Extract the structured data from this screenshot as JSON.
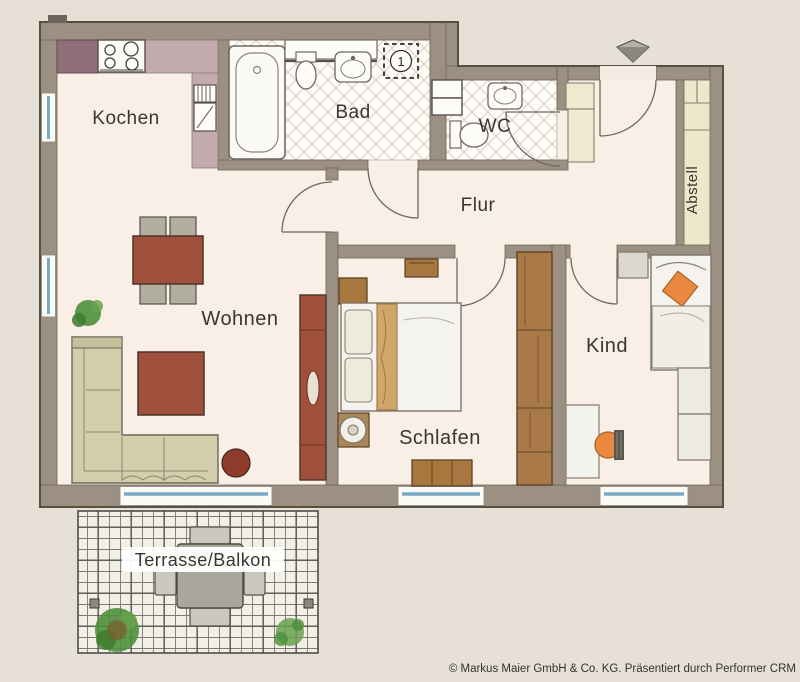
{
  "plan": {
    "rooms": {
      "kochen": {
        "label": "Kochen"
      },
      "bad": {
        "label": "Bad"
      },
      "wc": {
        "label": "WC"
      },
      "flur": {
        "label": "Flur"
      },
      "abstell": {
        "label": "Abstell"
      },
      "wohnen": {
        "label": "Wohnen"
      },
      "schlafen": {
        "label": "Schlafen"
      },
      "kind": {
        "label": "Kind"
      },
      "terrasse": {
        "label": "Terrasse/Balkon"
      }
    },
    "markers": {
      "entrance_number": "1"
    },
    "colors": {
      "background": "#e7e0d7",
      "wall": "#9c9083",
      "floor": "#f9efe7",
      "tile": "#fdfcf8",
      "abstell_floor": "#ede7cb",
      "window_glass": "#7aa9c4",
      "furniture_red": "#a0513d",
      "furniture_brown": "#a8763f",
      "accent_orange": "#e8893f",
      "sofa": "#d5cead",
      "plant_green": "#4e8f3c"
    }
  },
  "footer": {
    "copyright": "© Markus Maier GmbH & Co. KG. Präsentiert durch Performer CRM"
  }
}
